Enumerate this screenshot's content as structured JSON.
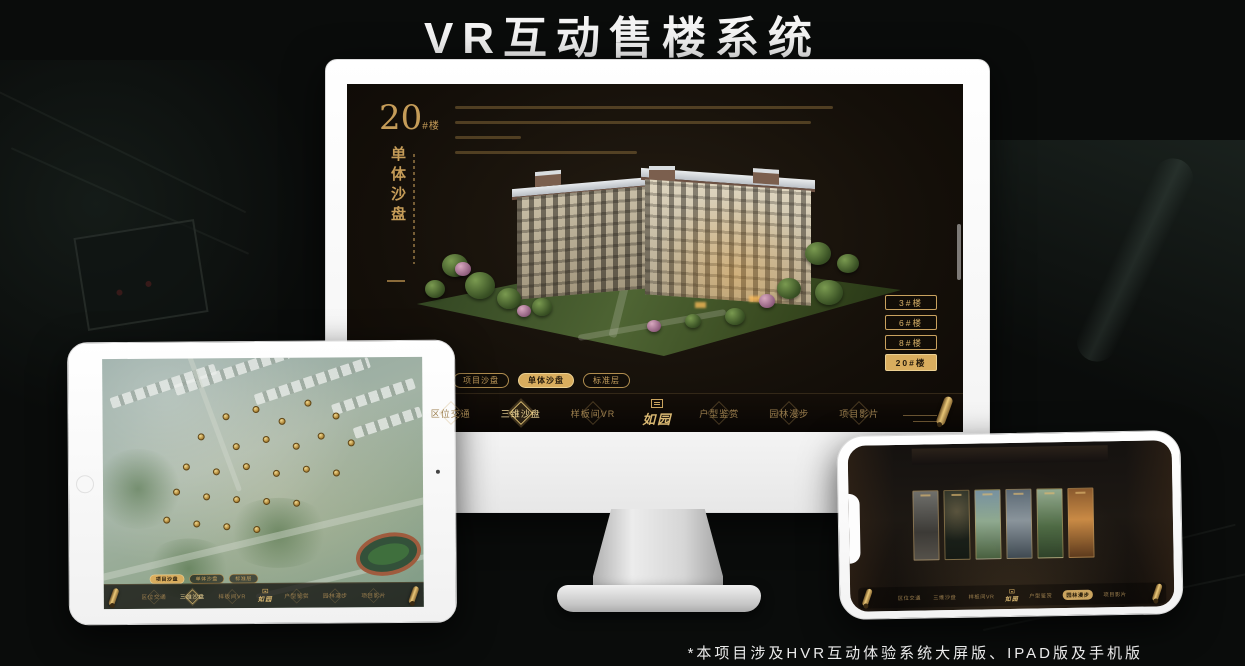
{
  "colors": {
    "gold": "#c9a25f",
    "gold_bright": "#ecd193",
    "gold_fill": "#d9ad5e",
    "dark_text": "#241a0c",
    "title_white": "#f4f4f4"
  },
  "page": {
    "title": "VR互动售楼系统",
    "footnote": "*本项目涉及HVR互动体验系统大屏版、IPAD版及手机版"
  },
  "monitor": {
    "heading": {
      "number": "20",
      "suffix": "#楼",
      "vertical_title": "单体沙盘"
    },
    "floor_buttons": [
      {
        "label": "3#楼",
        "selected": false
      },
      {
        "label": "6#楼",
        "selected": false
      },
      {
        "label": "8#楼",
        "selected": false
      },
      {
        "label": "20#楼",
        "selected": true
      }
    ],
    "sub_tabs": [
      {
        "label": "项目沙盘",
        "selected": false
      },
      {
        "label": "单体沙盘",
        "selected": true
      },
      {
        "label": "标准层",
        "selected": false
      }
    ],
    "nav": {
      "logo": "如园",
      "items": [
        {
          "label": "区位交通",
          "selected": false
        },
        {
          "label": "三维沙盘",
          "selected": true
        },
        {
          "label": "样板间VR",
          "selected": false
        },
        {
          "label": "户型鉴赏",
          "selected": false
        },
        {
          "label": "园林漫步",
          "selected": false
        },
        {
          "label": "项目影片",
          "selected": false
        }
      ]
    }
  },
  "tablet": {
    "sub_tabs": [
      {
        "label": "项目沙盘",
        "selected": true
      },
      {
        "label": "单体沙盘",
        "selected": false
      },
      {
        "label": "标准层",
        "selected": false
      }
    ],
    "nav": {
      "logo": "如园",
      "items": [
        {
          "label": "区位交通",
          "selected": false
        },
        {
          "label": "三维沙盘",
          "selected": true
        },
        {
          "label": "样板间VR",
          "selected": false
        },
        {
          "label": "户型鉴赏",
          "selected": false
        },
        {
          "label": "园林漫步",
          "selected": false
        },
        {
          "label": "项目影片",
          "selected": false
        }
      ]
    }
  },
  "phone": {
    "nav": {
      "logo": "如园",
      "items": [
        {
          "label": "区位交通",
          "selected": false
        },
        {
          "label": "三维沙盘",
          "selected": false
        },
        {
          "label": "样板间VR",
          "selected": false
        },
        {
          "label": "户型鉴赏",
          "selected": false
        },
        {
          "label": "园林漫步",
          "selected": true
        },
        {
          "label": "项目影片",
          "selected": false
        }
      ]
    }
  }
}
